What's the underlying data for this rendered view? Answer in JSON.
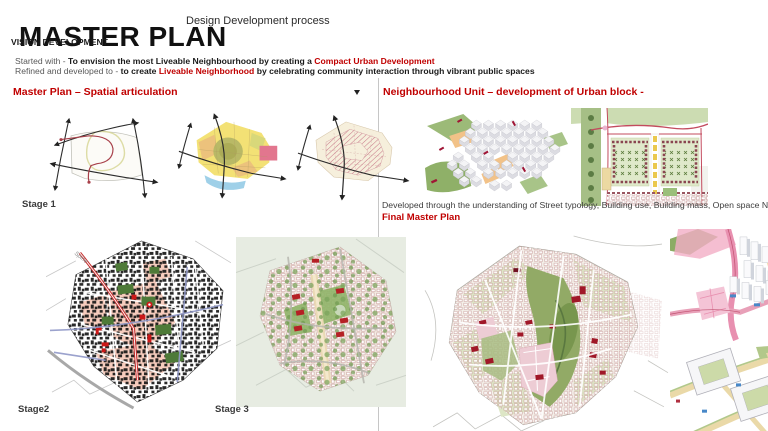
{
  "header": {
    "title": "MASTER PLAN",
    "subtitle": "Design Development process"
  },
  "vision": {
    "heading": "VISION DEVELOPMENT",
    "line1_prefix": "Started with - ",
    "line1_main": "To envision the most Liveable Neighbourhood by creating a ",
    "line1_highlight": "Compact Urban Development",
    "line2_prefix": "Refined and developed to - ",
    "line2_main": "to create ",
    "line2_highlight": "Liveable Neighborhood",
    "line2_tail": " by celebrating community interaction through vibrant public spaces"
  },
  "left_section": {
    "heading": "Master Plan – Spatial articulation",
    "stage1_label": "Stage 1",
    "stage2_label": "Stage2",
    "stage3_label": "Stage 3",
    "spine_annotation": "Spine"
  },
  "right_section": {
    "heading": "Neighbourhood Unit – development of  Urban block -",
    "caption": "Developed through the understanding  of Street typology, Building use, Building mass, Open space Network",
    "final_heading": "Final Master Plan"
  },
  "colors": {
    "accent_red": "#C00000",
    "text_dark": "#1a1a1a",
    "text_gray": "#595959",
    "divider_gray": "#c6c6c6",
    "spine_road_red": "#c83030",
    "park_green": "#4e7a38",
    "map_pink": "#f6ccbd"
  }
}
